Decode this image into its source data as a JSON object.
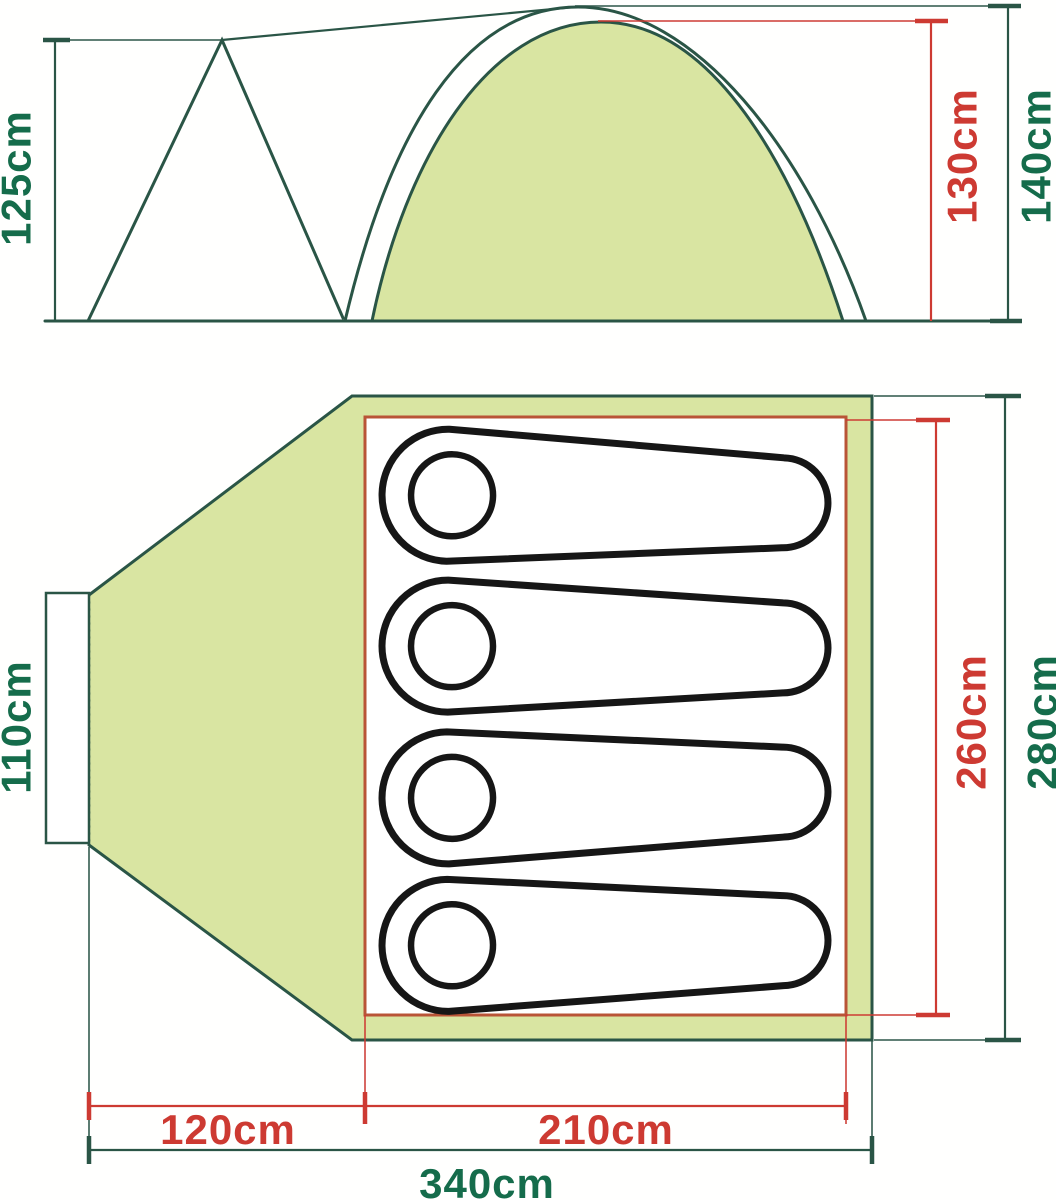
{
  "title": "Tent dimensions diagram (side view and floor plan)",
  "colors": {
    "line-green": "#2a5546",
    "text-green": "#156c4b",
    "dim-red": "#cd3a32",
    "fill-green": "#d9e5a2",
    "inner-border": "#b95437",
    "bag-black": "#161616"
  },
  "side_view": {
    "name": "side elevation of tent with porch peak and dome",
    "dimensions": {
      "porch_height": "125cm",
      "inner_height": "130cm",
      "outer_height": "140cm"
    }
  },
  "floor_plan": {
    "name": "top-down floor plan with porch, door and inner sleeping area",
    "sleeping_bag_count": 4,
    "dimensions": {
      "door_width": "110cm",
      "inner_length": "260cm",
      "outer_length": "280cm",
      "porch_depth": "120cm",
      "inner_width": "210cm",
      "total_width": "340cm"
    }
  }
}
